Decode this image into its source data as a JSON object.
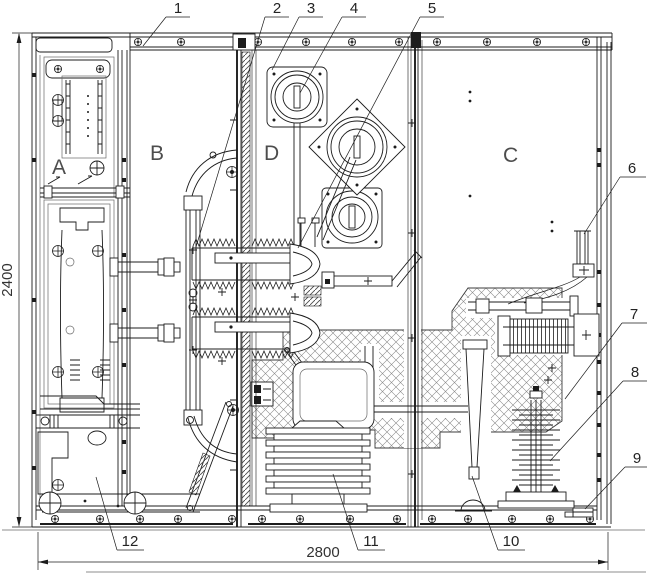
{
  "drawing": {
    "type": "technical-cad-cross-section",
    "compartments": {
      "a": "A",
      "b": "B",
      "d": "D",
      "c": "C"
    },
    "callouts": {
      "c1": "1",
      "c2": "2",
      "c3": "3",
      "c4": "4",
      "c5": "5",
      "c6": "6",
      "c7": "7",
      "c8": "8",
      "c9": "9",
      "c10": "10",
      "c11": "11",
      "c12": "12"
    },
    "dimensions": {
      "height": "2400",
      "width": "2800"
    },
    "colors": {
      "line": "#1c1c1c",
      "secondary": "#6a6a6a",
      "hatch": "#808080",
      "background": "#ffffff"
    }
  }
}
